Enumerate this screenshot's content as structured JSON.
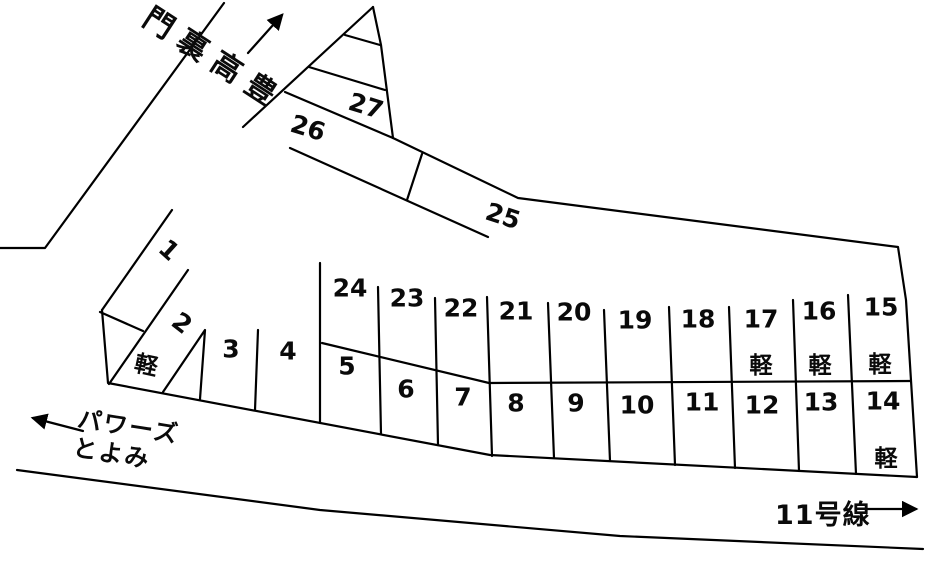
{
  "landmarks": {
    "back_gate": "豊高裏門",
    "powers_line1": "パワーズ",
    "powers_line2": "とよみ",
    "route": "11号線"
  },
  "kei_label": "軽",
  "spaces": [
    "1",
    "2",
    "3",
    "4",
    "5",
    "6",
    "7",
    "8",
    "9",
    "10",
    "11",
    "12",
    "13",
    "14",
    "15",
    "16",
    "17",
    "18",
    "19",
    "20",
    "21",
    "22",
    "23",
    "24",
    "25",
    "26",
    "27"
  ],
  "colors": {
    "line": "#000000",
    "background": "#ffffff",
    "text": "#0a0a0a"
  }
}
